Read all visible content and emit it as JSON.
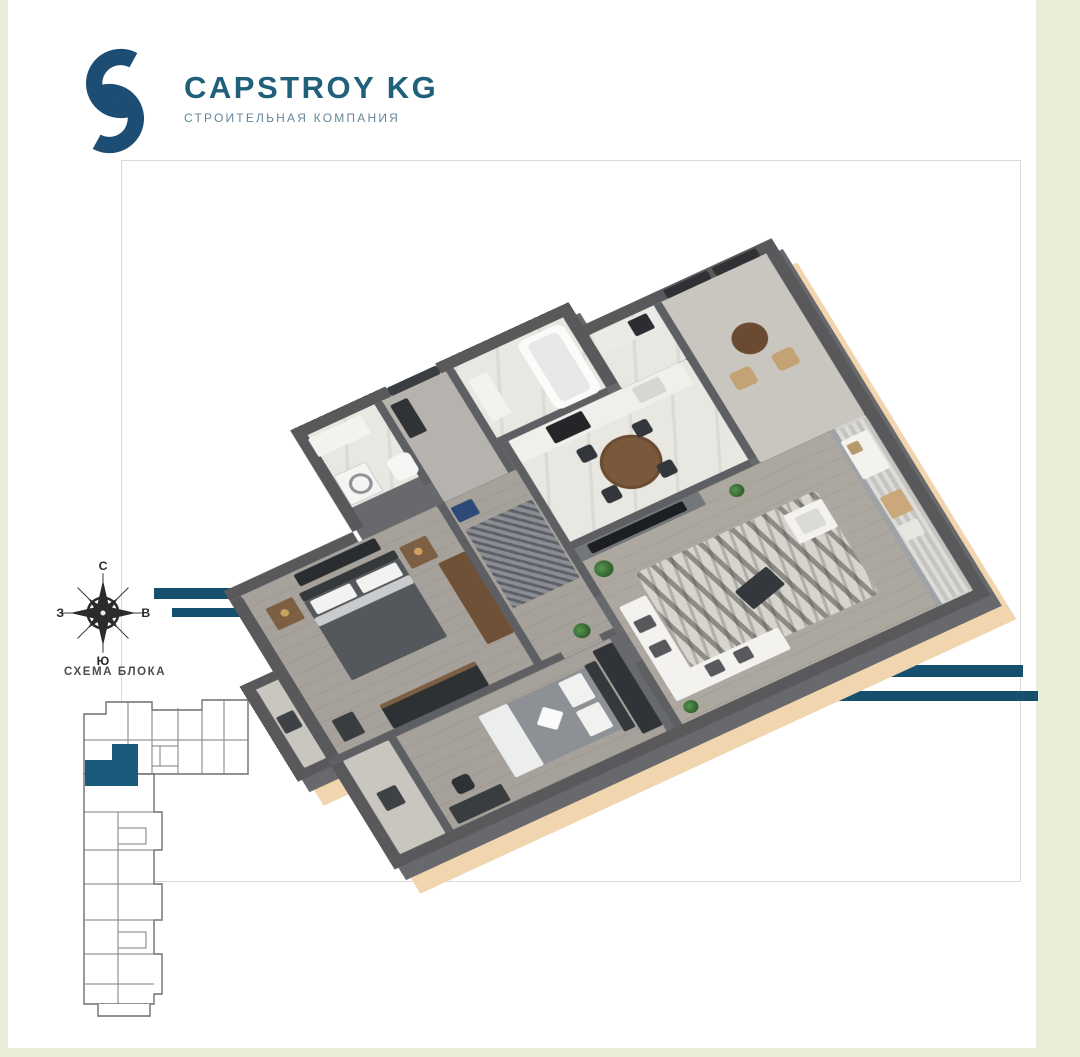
{
  "logo": {
    "title": "CAPSTROY KG",
    "subtitle": "СТРОИТЕЛЬНАЯ КОМПАНИЯ"
  },
  "compass": {
    "north": "С",
    "east": "В",
    "south": "Ю",
    "west": "З"
  },
  "block_scheme": {
    "label": "СХЕМА БЛОКА",
    "highlight_color": "#1a5b7d"
  },
  "colors": {
    "page_background": "#e9eed9",
    "sheet_background": "#ffffff",
    "frame_border": "#d9d9d9",
    "brand_mark": "#1d4d72",
    "brand_title": "#20607a",
    "brand_subtitle": "#64869a",
    "accent_stripe": "#15506f",
    "wall_gray": "#59595b",
    "slab_edge": "#f0d5ae",
    "floor_wood": "#a6a29b",
    "floor_tile": "#e9e7e2"
  }
}
